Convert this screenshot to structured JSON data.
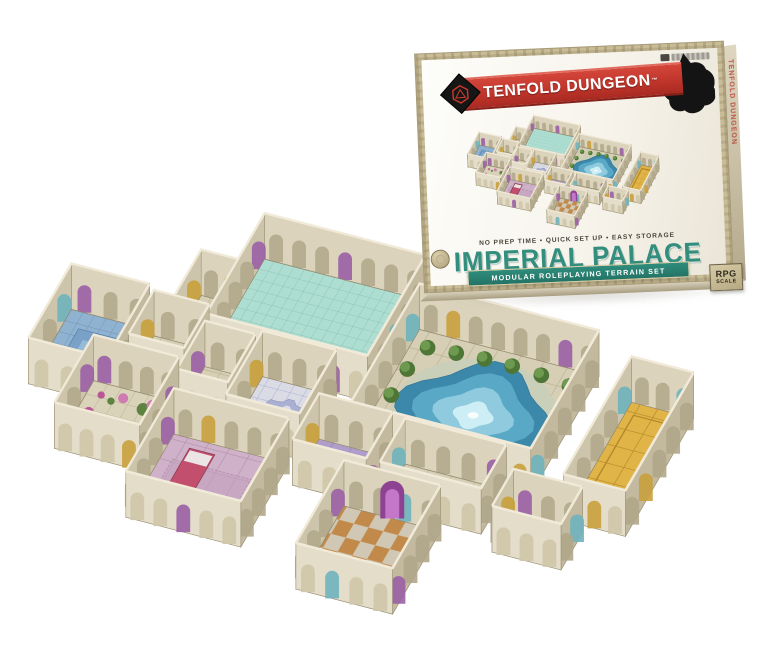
{
  "box": {
    "brand": "TENFOLD DUNGEON",
    "trademark": "TM",
    "tagline": "NO PREP TIME • QUICK SET UP • EASY STORAGE",
    "title": "IMPERIAL PALACE",
    "subtitle": "MODULAR ROLEPLAYING TERRAIN SET",
    "side_text": "TENFOLD DUNGEON",
    "scale_badge": {
      "line1": "RPG",
      "line2": "SCALE"
    },
    "colors": {
      "banner_red": "#c0352b",
      "title_teal": "#338e7e",
      "ribbon_teal": "#2f8c7c",
      "frame_tan": "#c9bd98"
    }
  },
  "scene": {
    "axis": {
      "ux": 1,
      "uy": 0.26,
      "vx": -0.55,
      "vy": 0.95
    },
    "projections": {
      "main": {
        "svg": "main-scene",
        "s": 46,
        "ox": 122,
        "oy": 222,
        "wh": 46
      },
      "mini": {
        "svg": "box-photo-svg",
        "s": 13.2,
        "ox": 46,
        "oy": 18,
        "wh": 13
      }
    },
    "wall": {
      "int_n": "#dbd3bc",
      "int_w": "#cdc5ab",
      "ext_s": "#e4ddc9",
      "ext_e": "#c3b99e",
      "rim": "#f1ead8",
      "edge": "#9d9378",
      "arch_int": "#b2a88c",
      "arch_ext": "#cfc6aa",
      "arch_ext_e": "#b0a688",
      "accents": [
        "#6fb3bd",
        "#9a5fa5",
        "#c9a03c"
      ]
    },
    "floors": {
      "tealTiles": {
        "bg": "#aeded2",
        "line": "#83bcae",
        "t": 0.22
      },
      "blueTiles": {
        "bg": "#8fb2d0",
        "line": "#6f93b8",
        "t": 0.25
      },
      "stone": {
        "bg": "#d6cfb6",
        "line": "#c0b698",
        "t": 0.5
      },
      "cobble": {
        "bg": "#d9d3ba",
        "line": "#bcb295",
        "t": 0.3
      },
      "gold": {
        "bg": "#e0b446",
        "line": "#b2862a",
        "t": 0.38
      },
      "checker": {
        "c1": "#c18a4b",
        "c2": "#d0c8b4",
        "t": 0.32
      },
      "carpet": {
        "bg": "#cfb2c9",
        "line": "#b793af",
        "t": 0.45
      },
      "purpleCarpet": {
        "bg": "#b19dca",
        "line": "#9780b5",
        "t": 0.4
      },
      "mosaic": {
        "bg": "#dadbe5",
        "line": "#a9afce",
        "t": 0.28
      }
    },
    "pool_layers": [
      {
        "k": 1.14,
        "fill": "#c9cfb9",
        "lobes": 0
      },
      {
        "k": 1.0,
        "fill": "#3c88aa",
        "lobes": 4
      },
      {
        "k": 0.78,
        "fill": "#58a8c6",
        "lobes": 4
      },
      {
        "k": 0.52,
        "fill": "#8fcade",
        "lobes": 4
      },
      {
        "k": 0.26,
        "fill": "#cdeef4",
        "lobes": 4
      }
    ],
    "flower_colors": [
      "#bb5596",
      "#d07ab2",
      "#5e8340",
      "#6f9449"
    ],
    "tree_colors": {
      "dark": "#4e7636",
      "light": "#6e9a50"
    },
    "bed_colors": {
      "frame": "#c24f6d",
      "frame_edge": "#8d3a52",
      "pillow": "#ebe5e5",
      "rug": "#c3a2bd",
      "rug_edge": "#9b7493"
    },
    "bath_pool": {
      "fill": "#7aa2c8",
      "edge": "#5d84ad",
      "inner": "#9cc0dc"
    },
    "mosaic_medallion": {
      "outer": "#a9b0d2",
      "mid": "#dcdde9",
      "core": "#9099c2",
      "edge": "#8d94bc"
    },
    "vase_colors": {
      "fill": "#f0ece2",
      "edge": "#b3a98f"
    },
    "purple_arch": {
      "outer": "#8d4392",
      "inner": "#c477c9"
    },
    "gold_runner": {
      "edge": "#b2862a"
    },
    "rooms": [
      {
        "id": "grand-hall",
        "x": 3.1,
        "y": 0.0,
        "w": 3.5,
        "h": 2.3,
        "floor": "tealTiles"
      },
      {
        "id": "pool-courtyard",
        "x": 6.8,
        "y": 0.6,
        "w": 3.9,
        "h": 2.7,
        "floor": "stone",
        "feature": "pool",
        "trees": [
          [
            7.15,
            0.92
          ],
          [
            7.75,
            0.88
          ],
          [
            8.35,
            0.85
          ],
          [
            8.95,
            0.85
          ],
          [
            9.6,
            0.88
          ],
          [
            10.25,
            0.95
          ],
          [
            7.0,
            1.45
          ],
          [
            6.98,
            2.05
          ],
          [
            7.0,
            2.6
          ],
          [
            10.45,
            1.5
          ]
        ]
      },
      {
        "id": "gold-hall",
        "x": 11.6,
        "y": 0.95,
        "w": 1.35,
        "h": 2.7,
        "floor": "gold",
        "feature": "gold-runner"
      },
      {
        "id": "ante-room",
        "x": 2.3,
        "y": 1.05,
        "w": 0.85,
        "h": 1.15,
        "floor": "stone"
      },
      {
        "id": "west-bath",
        "x": 0.0,
        "y": 2.0,
        "w": 1.7,
        "h": 1.7,
        "floor": "blueTiles",
        "feature": "bath-pool"
      },
      {
        "id": "west-room",
        "x": 1.85,
        "y": 2.1,
        "w": 1.2,
        "h": 1.0,
        "floor": "stone"
      },
      {
        "id": "mid-corridor",
        "x": 3.15,
        "y": 2.45,
        "w": 1.1,
        "h": 1.1,
        "floor": "stone"
      },
      {
        "id": "mosaic-room",
        "x": 4.35,
        "y": 2.35,
        "w": 1.6,
        "h": 1.45,
        "floor": "mosaic",
        "feature": "mosaic-medallion"
      },
      {
        "id": "garden-room",
        "x": 1.2,
        "y": 3.3,
        "w": 1.85,
        "h": 1.55,
        "floor": "cobble",
        "feature": "flowers",
        "flowers": [
          [
            1.5,
            3.55
          ],
          [
            1.95,
            3.5
          ],
          [
            2.45,
            3.62
          ],
          [
            2.8,
            3.78
          ],
          [
            1.45,
            3.95
          ],
          [
            2.6,
            3.5
          ],
          [
            1.75,
            3.62
          ]
        ]
      },
      {
        "id": "throne-corridor",
        "x": 6.1,
        "y": 3.3,
        "w": 1.6,
        "h": 1.05,
        "floor": "purpleCarpet"
      },
      {
        "id": "statue-hall",
        "x": 8.0,
        "y": 3.35,
        "w": 2.2,
        "h": 1.0,
        "floor": "stone",
        "feature": "vases",
        "vases": [
          [
            8.5,
            3.82
          ],
          [
            9.1,
            3.82
          ],
          [
            9.72,
            3.82
          ]
        ]
      },
      {
        "id": "bedroom",
        "x": 3.3,
        "y": 3.95,
        "w": 2.5,
        "h": 1.9,
        "floor": "carpet",
        "feature": "bed"
      },
      {
        "id": "east-room",
        "x": 10.6,
        "y": 3.8,
        "w": 1.5,
        "h": 0.85,
        "floor": "stone"
      },
      {
        "id": "orange-room",
        "x": 7.3,
        "y": 4.5,
        "w": 2.1,
        "h": 1.9,
        "floor": "checker",
        "feature": "purple-arch"
      }
    ]
  }
}
